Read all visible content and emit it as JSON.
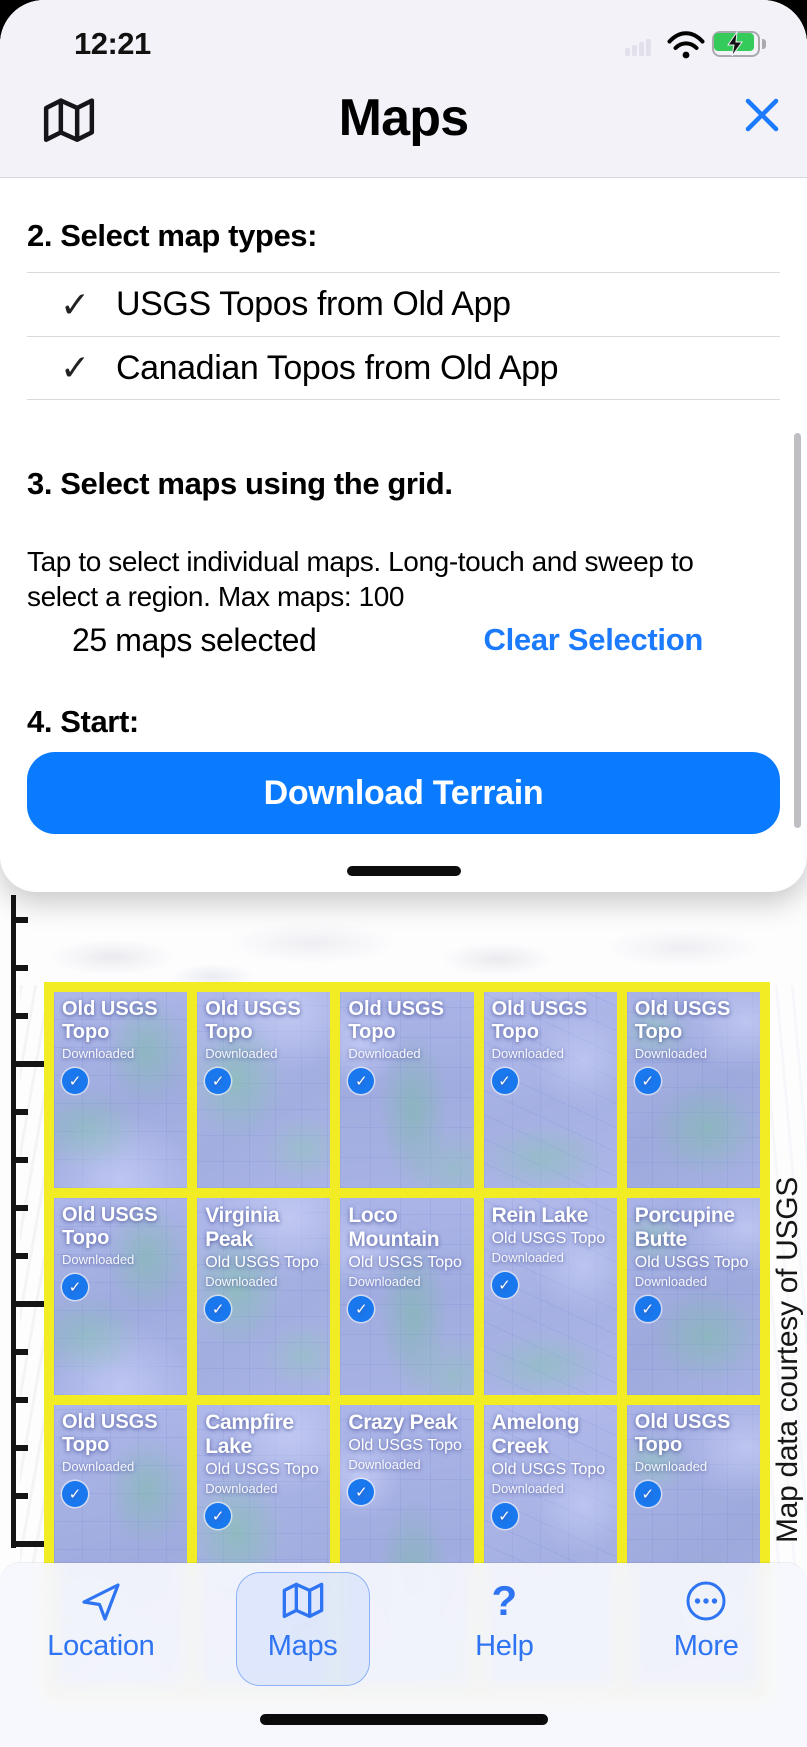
{
  "status_bar": {
    "time": "12:21",
    "icons": [
      {
        "name": "cellular-icon"
      },
      {
        "name": "wifi-icon"
      },
      {
        "name": "battery-charging-icon"
      }
    ]
  },
  "header": {
    "title": "Maps"
  },
  "icons": {
    "check_glyph": "✓",
    "tile_check_glyph": "✓"
  },
  "sheet": {
    "step2": {
      "heading": "2. Select map types:",
      "options": [
        {
          "label": "USGS Topos from Old App",
          "checked": true
        },
        {
          "label": "Canadian Topos from Old App",
          "checked": true
        }
      ]
    },
    "step3": {
      "heading": "3. Select maps using the grid.",
      "description": "Tap to select individual maps. Long-touch and sweep to select a region. Max maps: 100",
      "selected_count": "25 maps selected",
      "clear_label": "Clear Selection"
    },
    "step4": {
      "heading": "4. Start:",
      "download_label": "Download Terrain"
    }
  },
  "map": {
    "attribution": "Map data courtesy of USGS",
    "tiles": [
      {
        "name": "",
        "type": "Old USGS Topo",
        "status": "Downloaded",
        "selected": true
      },
      {
        "name": "",
        "type": "Old USGS Topo",
        "status": "Downloaded",
        "selected": true
      },
      {
        "name": "",
        "type": "Old USGS Topo",
        "status": "Downloaded",
        "selected": true
      },
      {
        "name": "",
        "type": "Old USGS Topo",
        "status": "Downloaded",
        "selected": true
      },
      {
        "name": "",
        "type": "Old USGS Topo",
        "status": "Downloaded",
        "selected": true
      },
      {
        "name": "",
        "type": "Old USGS Topo",
        "status": "Downloaded",
        "selected": true
      },
      {
        "name": "Virginia Peak",
        "type": "Old USGS Topo",
        "status": "Downloaded",
        "selected": true
      },
      {
        "name": "Loco Mountain",
        "type": "Old USGS Topo",
        "status": "Downloaded",
        "selected": true
      },
      {
        "name": "Rein Lake",
        "type": "Old USGS Topo",
        "status": "Downloaded",
        "selected": true
      },
      {
        "name": "Porcupine Butte",
        "type": "Old USGS Topo",
        "status": "Downloaded",
        "selected": true
      },
      {
        "name": "",
        "type": "Old USGS Topo",
        "status": "Downloaded",
        "selected": true
      },
      {
        "name": "Campfire Lake",
        "type": "Old USGS Topo",
        "status": "Downloaded",
        "selected": true
      },
      {
        "name": "Crazy Peak",
        "type": "Old USGS Topo",
        "status": "Downloaded",
        "selected": true
      },
      {
        "name": "Amelong Creek",
        "type": "Old USGS Topo",
        "status": "Downloaded",
        "selected": true
      },
      {
        "name": "",
        "type": "Old USGS Topo",
        "status": "Downloaded",
        "selected": true
      }
    ]
  },
  "tab_bar": {
    "items": [
      {
        "label": "Location",
        "icon": "location-icon",
        "active": false
      },
      {
        "label": "Maps",
        "icon": "maps-icon",
        "active": true
      },
      {
        "label": "Help",
        "icon": "help-icon",
        "glyph": "?",
        "active": false
      },
      {
        "label": "More",
        "icon": "more-icon",
        "active": false
      }
    ]
  },
  "colors": {
    "accent_blue": "#1b7afe",
    "button_blue": "#0a7bff",
    "grid_yellow": "#f2ec25",
    "tile_blue": "#a9b3e6",
    "badge_blue": "#1a78ef",
    "battery_green": "#35cb5b"
  }
}
